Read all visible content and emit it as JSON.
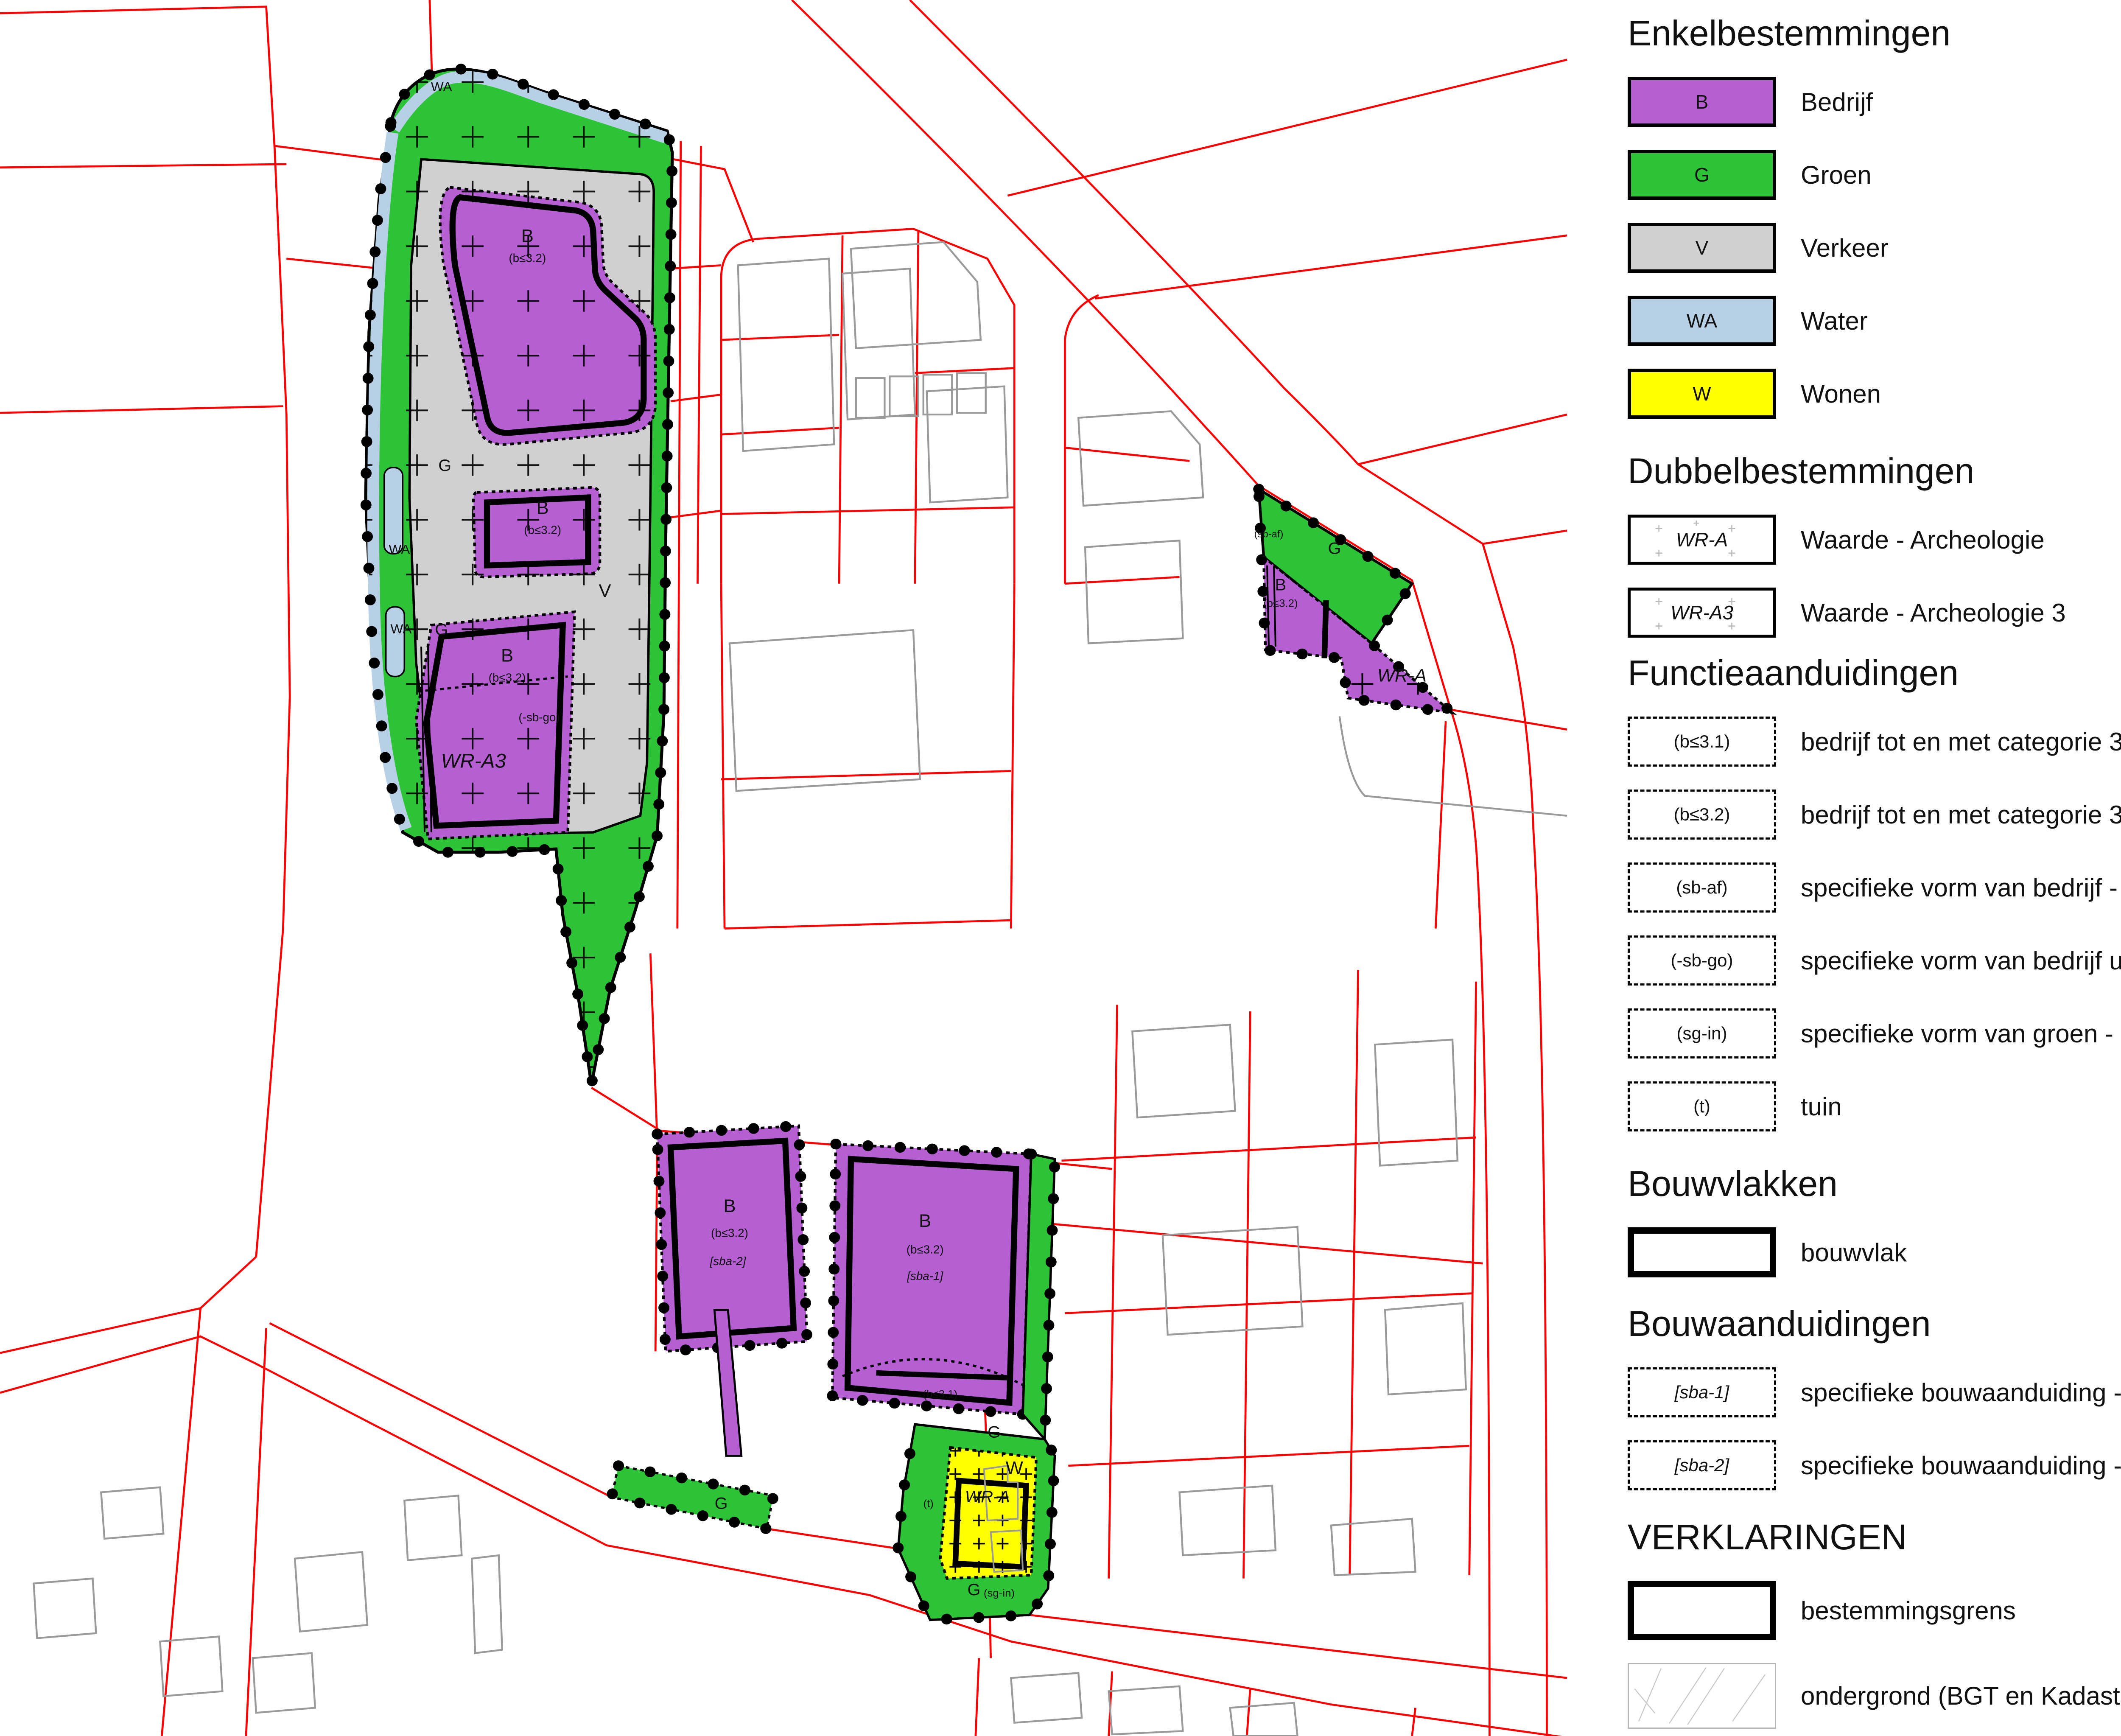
{
  "colors": {
    "bedrijf": "#b55fd3",
    "groen": "#2cc436",
    "verkeer": "#d0d0d0",
    "water": "#b8d0e6",
    "wonen": "#ffff00",
    "cadastral_line": "#ff0000",
    "building_outline": "#9a9a9a",
    "boundary": "#000000"
  },
  "map": {
    "region_labels": [
      {
        "text": "WA"
      },
      {
        "text": "G"
      },
      {
        "text": "B"
      },
      {
        "text": "(b≤3.2)"
      },
      {
        "text": "WA"
      },
      {
        "text": "B"
      },
      {
        "text": "(b≤3.2)"
      },
      {
        "text": "V"
      },
      {
        "text": "WA"
      },
      {
        "text": "G"
      },
      {
        "text": "B"
      },
      {
        "text": "(b≤3.2)"
      },
      {
        "text": "(-sb-go)"
      },
      {
        "text": "WR-A3"
      },
      {
        "text": "G"
      },
      {
        "text": "(sb-af)"
      },
      {
        "text": "B"
      },
      {
        "text": "(b≤3.2)"
      },
      {
        "text": "WR-A"
      },
      {
        "text": "B"
      },
      {
        "text": "(b≤3.2)"
      },
      {
        "text": "[sba-2]"
      },
      {
        "text": "B"
      },
      {
        "text": "(b≤3.2)"
      },
      {
        "text": "[sba-1]"
      },
      {
        "text": "(b≤3.1)"
      },
      {
        "text": "G"
      },
      {
        "text": "G"
      },
      {
        "text": "W"
      },
      {
        "text": "WR-A"
      },
      {
        "text": "(t)"
      },
      {
        "text": "G"
      },
      {
        "text": "(sg-in)"
      }
    ]
  },
  "legend": {
    "sections": [
      {
        "title": "Enkelbestemmingen",
        "items": [
          {
            "code": "B",
            "label": "Bedrijf"
          },
          {
            "code": "G",
            "label": "Groen"
          },
          {
            "code": "V",
            "label": "Verkeer"
          },
          {
            "code": "WA",
            "label": "Water"
          },
          {
            "code": "W",
            "label": "Wonen"
          }
        ]
      },
      {
        "title": "Dubbelbestemmingen",
        "items": [
          {
            "code": "WR-A",
            "label": "Waarde - Archeologie"
          },
          {
            "code": "WR-A3",
            "label": "Waarde - Archeologie 3"
          }
        ]
      },
      {
        "title": "Functieaanduidingen",
        "items": [
          {
            "code": "(b≤3.1)",
            "label": "bedrijf tot en met categorie 3.1"
          },
          {
            "code": "(b≤3.2)",
            "label": "bedrijf tot en met categorie 3.2"
          },
          {
            "code": "(sb-af)",
            "label": "specifieke vorm van bedrijf - erfafscheiding"
          },
          {
            "code": "(-sb-go)",
            "label": "specifieke vorm van bedrijf uitgesloten - geurgevoelig object"
          },
          {
            "code": "(sg-in)",
            "label": "specifieke vorm van groen - inrit"
          },
          {
            "code": "(t)",
            "label": "tuin"
          }
        ]
      },
      {
        "title": "Bouwvlakken",
        "items": [
          {
            "code": "",
            "label": "bouwvlak"
          }
        ]
      },
      {
        "title": "Bouwaanduidingen",
        "items": [
          {
            "code": "[sba-1]",
            "label": "specifieke bouwaanduiding - 1"
          },
          {
            "code": "[sba-2]",
            "label": "specifieke bouwaanduiding - 2"
          }
        ]
      },
      {
        "title": "VERKLARINGEN",
        "items": [
          {
            "code": "",
            "label": "bestemmingsgrens"
          },
          {
            "code": "",
            "label": "ondergrond (BGT en Kadastrale ondergronden)"
          }
        ]
      }
    ]
  }
}
